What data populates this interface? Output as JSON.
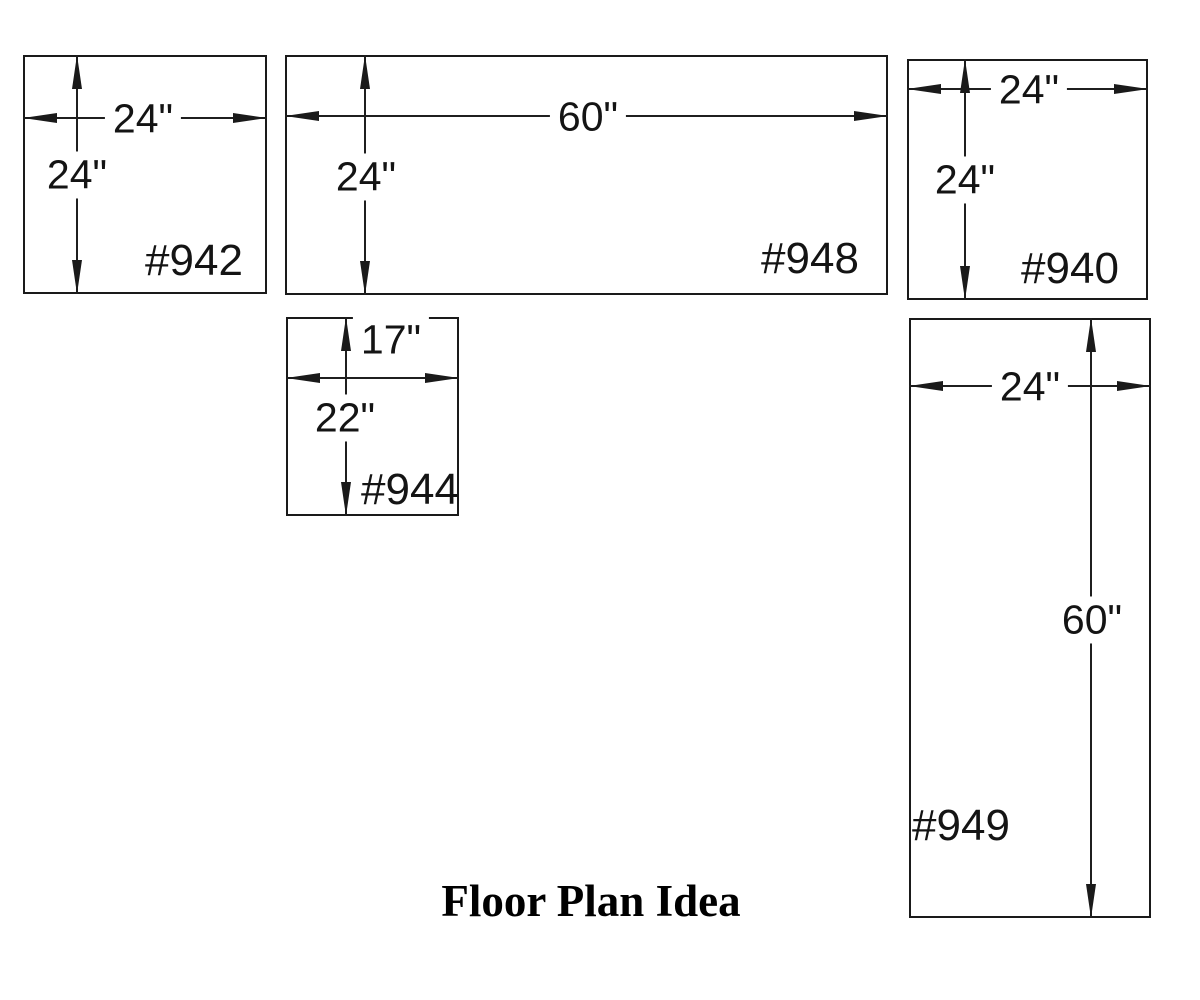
{
  "title": "Floor Plan Idea",
  "ink_color": "#1a1a1a",
  "boxes": [
    {
      "part_number": "#942",
      "width_label": "24\"",
      "height_label": "24\""
    },
    {
      "part_number": "#948",
      "width_label": "60\"",
      "height_label": "24\""
    },
    {
      "part_number": "#940",
      "width_label": "24\"",
      "height_label": "24\""
    },
    {
      "part_number": "#944",
      "width_label": "17\"",
      "height_label": "22\""
    },
    {
      "part_number": "#949",
      "width_label": "24\"",
      "height_label": "60\""
    }
  ]
}
